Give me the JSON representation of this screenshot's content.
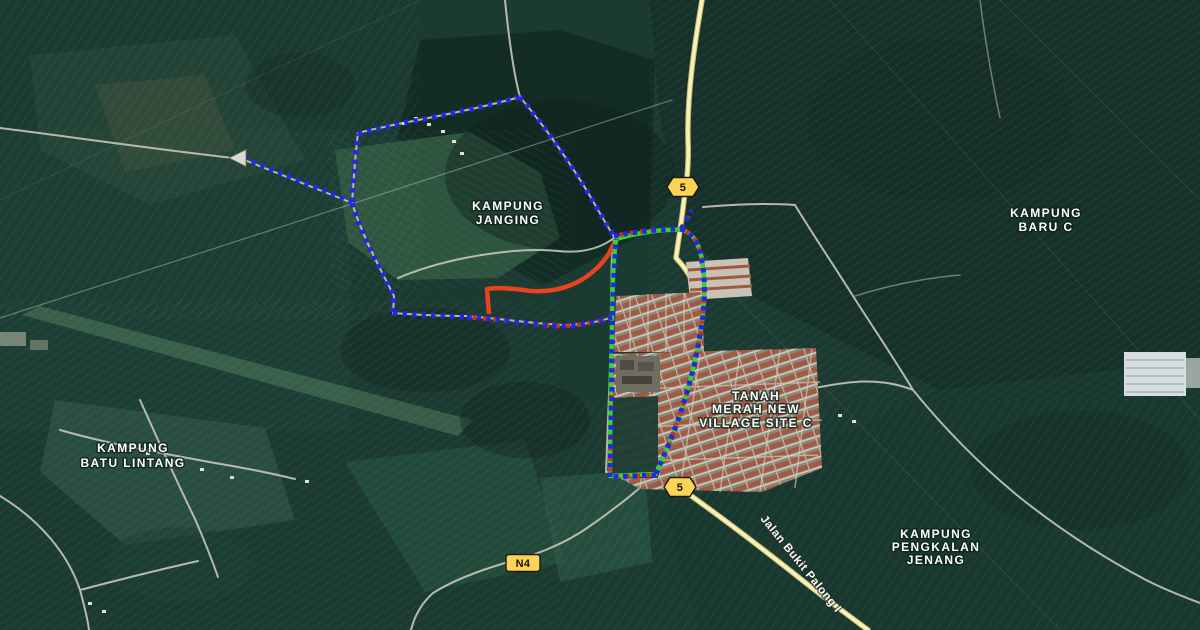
{
  "map": {
    "title": "Satellite map — Tanah Merah area",
    "place_labels": [
      {
        "id": "kampung-janging",
        "lines": [
          "KAMPUNG",
          "JANGING"
        ]
      },
      {
        "id": "kampung-baru-c",
        "lines": [
          "KAMPUNG",
          "BARU C"
        ]
      },
      {
        "id": "tanah-merah-new-village",
        "lines": [
          "TANAH",
          "MERAH NEW",
          "VILLAGE SITE C"
        ]
      },
      {
        "id": "kampung-batu-lintang",
        "lines": [
          "KAMPUNG",
          "BATU LINTANG"
        ]
      },
      {
        "id": "kampung-pengkalan-jenang",
        "lines": [
          "KAMPUNG",
          "PENGKALAN",
          "JENANG"
        ]
      }
    ],
    "road_labels": [
      {
        "id": "route-5-north",
        "text": "5"
      },
      {
        "id": "route-5-south",
        "text": "5"
      },
      {
        "id": "route-n4",
        "text": "N4"
      },
      {
        "id": "jalan-bukit-palong",
        "text": "Jalan Bukit Palong I"
      }
    ],
    "colors": {
      "track_blue": "#2428e0",
      "track_red_dash": "#d5301e",
      "route_green": "#33d42c",
      "route_red": "#e8431d",
      "road_yellow_fill": "#f8f0ba",
      "road_gray": "#c9c6bb",
      "shield_yellow": "#fbd456"
    }
  }
}
